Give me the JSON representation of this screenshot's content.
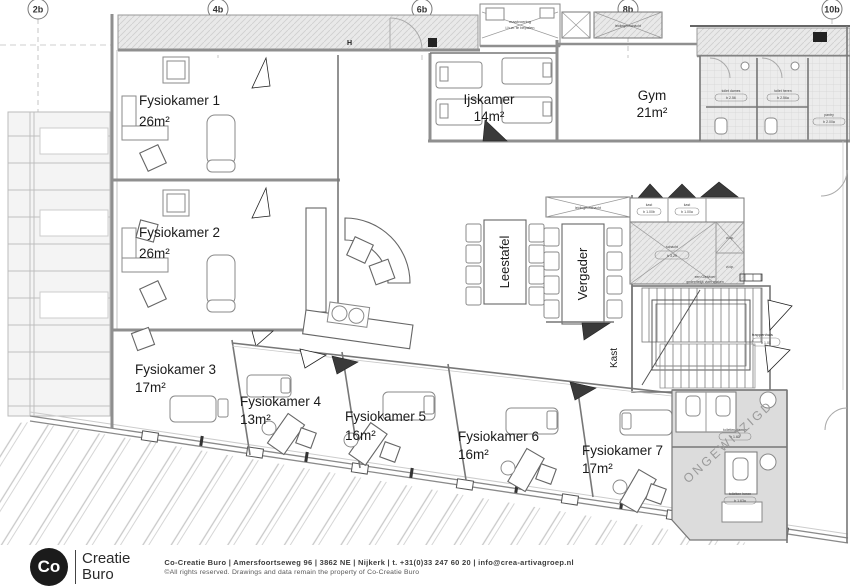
{
  "grid": {
    "labels": [
      "2b",
      "4b",
      "6b",
      "8b",
      "10b"
    ]
  },
  "rooms": {
    "fysio1": {
      "name": "Fysiokamer 1",
      "area": "26m²"
    },
    "fysio2": {
      "name": "Fysiokamer 2",
      "area": "26m²"
    },
    "fysio3": {
      "name": "Fysiokamer 3",
      "area": "17m²"
    },
    "fysio4": {
      "name": "Fysiokamer 4",
      "area": "13m²"
    },
    "fysio5": {
      "name": "Fysiokamer 5",
      "area": "16m²"
    },
    "fysio6": {
      "name": "Fysiokamer 6",
      "area": "16m²"
    },
    "fysio7": {
      "name": "Fysiokamer 7",
      "area": "17m²"
    },
    "ijskamer": {
      "name": "Ijskamer",
      "area": "14m²"
    },
    "gym": {
      "name": "Gym",
      "area": "21m²"
    },
    "leestafel": {
      "name": "Leestafel"
    },
    "vergader": {
      "name": "Vergader"
    },
    "kast": {
      "name": "Kast"
    }
  },
  "annotations": {
    "ongewijzigd": "ONGEWIJZIGD",
    "h_marker": "H",
    "maatvoering_1": "maatvoering",
    "maatvoering_2": "i.h.w. te bepalen",
    "schacht_top": "leidingenschacht",
    "schacht_vergader": "leidingenschacht",
    "toilet_dames": "toilet dames",
    "toilet_dames_code": "b 2.56",
    "toilet_heren": "toilet heren",
    "toilet_heren_code": "b 2.56a",
    "pantry": "pantry",
    "pantry_code": "b 2.00a",
    "kast_label_1": "kast",
    "kast_code_1": "b 1.00b",
    "kast_label_2": "kast",
    "kast_code_2": "b 1.00a",
    "schacht_label": "schacht",
    "schacht_code": "b 3.29",
    "vlop1": "vl.op.",
    "vlop2": "vl.op.",
    "vloer_1": "een Gietvloer",
    "vloer_2": "gedeeltelijk vloer maken",
    "trappenhuis": "trappenhuis",
    "trappenhuis_code": "b 1.01",
    "toiletten_dames": "toiletten dames",
    "toiletten_dames_code": "b 1.63",
    "toiletten_heren": "toiletten heren",
    "toiletten_heren_code": "b 1.63a"
  },
  "footer": {
    "logo_co": "Co",
    "logo_line1": "Creatie",
    "logo_line2": "Buro",
    "contact": "Co-Creatie Buro   |   Amersfoortseweg 96   |   3862 NE   |   Nijkerk   |   t. +31(0)33 247 60 20   |   info@crea-artivagroep.nl",
    "rights": "©All rights reserved. Drawings and data remain the property of Co-Creatie Buro"
  },
  "colors": {
    "wall_gray": "#8f8f8f",
    "hatch_bg": "#e9e9e9",
    "unchanged_area": "#dcdcdc",
    "logo_black": "#1b1b1b"
  }
}
